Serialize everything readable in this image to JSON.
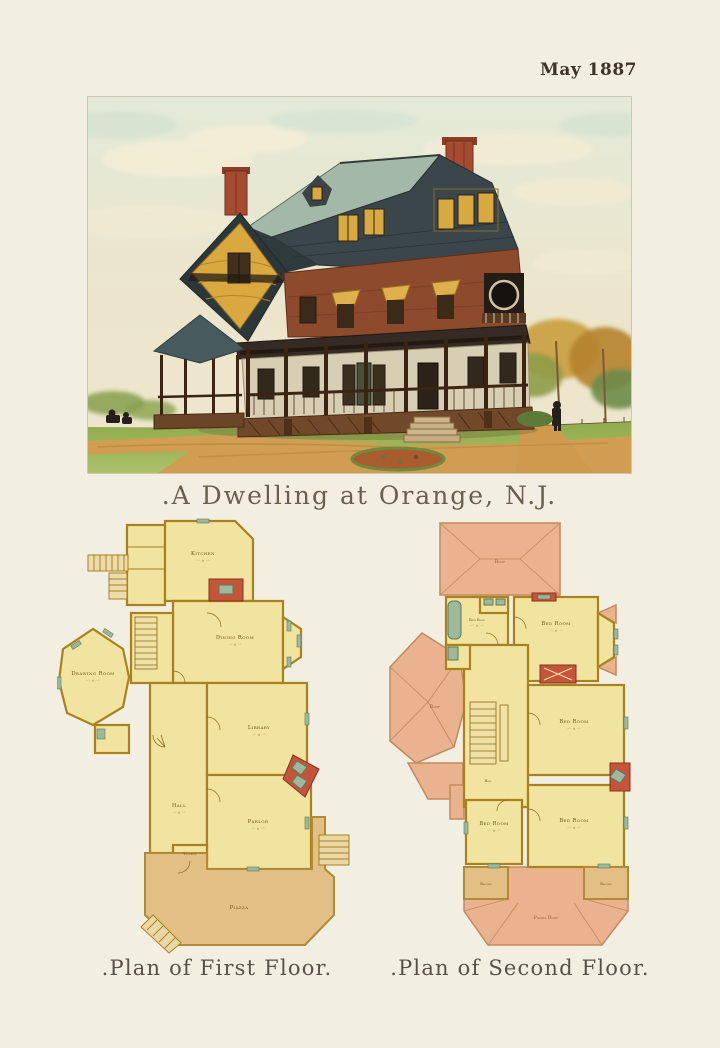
{
  "header": {
    "date": "May 1887"
  },
  "main_caption": ".A Dwelling at Orange, N.J.",
  "palette": {
    "paper": "#f3eee2",
    "ink": "#3c332a",
    "caption_ink": "#68604f",
    "plan_room_fill": "#f1e3a0",
    "plan_wall": "#a8821c",
    "porch_fill": "#e2c085",
    "roof_pink": "#eab28e",
    "accent_red": "#c4543a",
    "fixture_green": "#9db89b",
    "house_roof_slate": "#3a4649",
    "house_shingle_red": "#8d4a2d",
    "house_gable_ochre": "#d9a93f",
    "lawn_green": "#9bb458",
    "path_tan": "#d09d52"
  },
  "plans": {
    "first": {
      "caption": ".Plan of First Floor.",
      "rooms": {
        "kitchen": {
          "label": "Kitchen",
          "dims": "··'· × ··'·"
        },
        "dining_room": {
          "label": "Dining Room",
          "dims": "··'· × ··'·"
        },
        "drawing_room": {
          "label": "Drawing Room",
          "dims": "··'· × ··'·"
        },
        "library": {
          "label": "Library",
          "dims": "··'· × ··'·"
        },
        "hall": {
          "label": "Hall",
          "dims": "··'· × ··'·"
        },
        "parlor": {
          "label": "Parlor",
          "dims": "··'· × ··'·"
        },
        "vestibule": {
          "label": "Vestibule"
        },
        "piazza": {
          "label": "Piazza"
        }
      }
    },
    "second": {
      "caption": ".Plan of Second Floor.",
      "rooms": {
        "roof_top": {
          "label": "Roof"
        },
        "bath_room": {
          "label": "Bath Room",
          "dims": "··'· × ··'·"
        },
        "bed_room_1": {
          "label": "Bed Room",
          "dims": "··'· × ··'·"
        },
        "bed_room_2": {
          "label": "Bed Room",
          "dims": "··'· × ··'·"
        },
        "bed_room_3": {
          "label": "Bed Room",
          "dims": "··'· × ··'·"
        },
        "bed_room_4": {
          "label": "Bed Room",
          "dims": "··'· × ··'·"
        },
        "hall": {
          "label": "Hall"
        },
        "roof_octagon": {
          "label": "Roof"
        },
        "balcony_left": {
          "label": "Balcony"
        },
        "balcony_right": {
          "label": "Balcony"
        },
        "piazza_roof": {
          "label": "Piazza Roof"
        }
      }
    }
  }
}
